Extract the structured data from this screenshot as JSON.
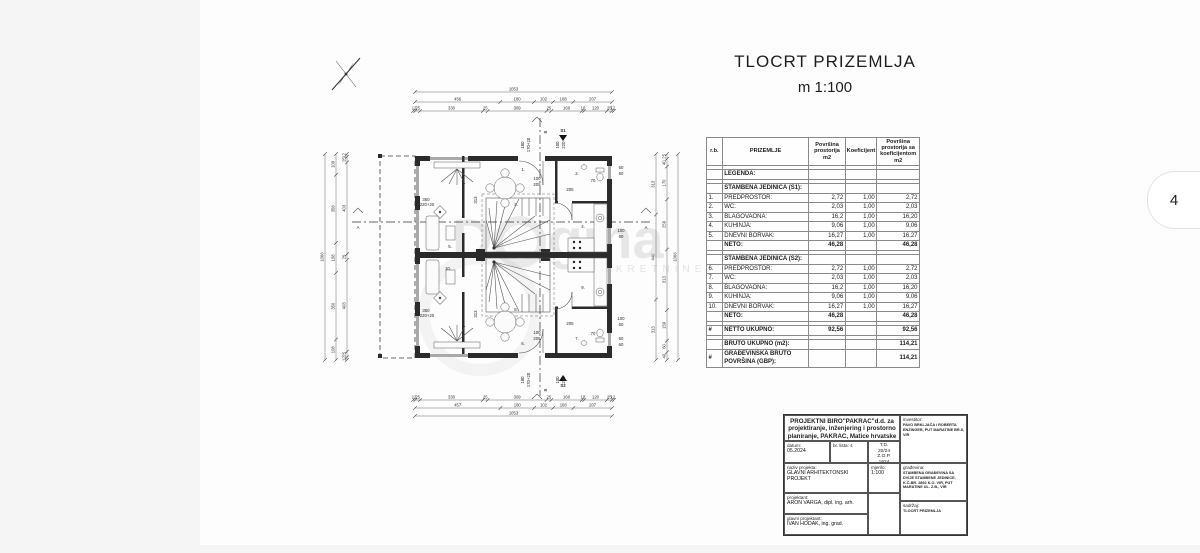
{
  "page": {
    "tab_number": "4"
  },
  "title": {
    "main": "TLOCRT  PRIZEMLJA",
    "scale": "m 1:100"
  },
  "watermark": {
    "part1": "D",
    "part2": "gma",
    "sub": "NEKRETNINE"
  },
  "plan": {
    "markers": {
      "a": "A",
      "b": "B",
      "s1": "S1",
      "s2": "S2"
    },
    "dims": {
      "top_total": [
        "1053"
      ],
      "top_mid": [
        "456",
        "180",
        "102",
        "108",
        "207"
      ],
      "top_small": [
        "12",
        "25",
        "330",
        "25",
        "309",
        "25",
        "160",
        "10",
        "120",
        "25",
        "12"
      ],
      "bot_small": [
        "12",
        "25",
        "330",
        "25",
        "309",
        "25",
        "160",
        "10",
        "120",
        "25",
        "12"
      ],
      "bot_mid": [
        "457",
        "180",
        "102",
        "108",
        "207"
      ],
      "bot_total": [
        "1053"
      ],
      "left_small": [
        "12",
        "25",
        "403",
        "25",
        "403",
        "25",
        "12"
      ],
      "left_mid": [
        "109",
        "358",
        "158",
        "350",
        "108"
      ],
      "left_total": [
        "1066"
      ],
      "right_inner": [
        "313",
        "440",
        "313"
      ],
      "right_mid": [
        "25",
        "40",
        "170",
        "259",
        "313",
        "159",
        "60",
        "40"
      ],
      "right_total": [
        "1066"
      ]
    },
    "labels": [
      {
        "t": "180",
        "x": 224,
        "y": 97,
        "r": -90
      },
      {
        "t": "170+20",
        "x": 230,
        "y": 97,
        "r": -90
      },
      {
        "t": "100",
        "x": 259,
        "y": 97,
        "r": -90
      },
      {
        "t": "220",
        "x": 265,
        "y": 97,
        "r": -90
      },
      {
        "t": "180",
        "x": 224,
        "y": 332,
        "r": -90
      },
      {
        "t": "170+20",
        "x": 230,
        "y": 332,
        "r": -90
      },
      {
        "t": "100",
        "x": 259,
        "y": 332,
        "r": -90
      },
      {
        "t": "220",
        "x": 265,
        "y": 332,
        "r": -90
      },
      {
        "t": "100",
        "x": 237,
        "y": 132
      },
      {
        "t": "205",
        "x": 237,
        "y": 138
      },
      {
        "t": "205",
        "x": 270,
        "y": 143
      },
      {
        "t": "100",
        "x": 237,
        "y": 286
      },
      {
        "t": "205",
        "x": 237,
        "y": 292
      },
      {
        "t": "205",
        "x": 270,
        "y": 277
      },
      {
        "t": "70",
        "x": 293,
        "y": 134
      },
      {
        "t": "70",
        "x": 293,
        "y": 287
      },
      {
        "t": "60",
        "x": 321,
        "y": 121
      },
      {
        "t": "60",
        "x": 321,
        "y": 127
      },
      {
        "t": "100",
        "x": 321,
        "y": 184
      },
      {
        "t": "60",
        "x": 321,
        "y": 190
      },
      {
        "t": "100",
        "x": 321,
        "y": 272
      },
      {
        "t": "60",
        "x": 321,
        "y": 278
      },
      {
        "t": "60",
        "x": 321,
        "y": 292
      },
      {
        "t": "60",
        "x": 321,
        "y": 298
      },
      {
        "t": "350",
        "x": 126,
        "y": 153
      },
      {
        "t": "220+20",
        "x": 127,
        "y": 158
      },
      {
        "t": "350",
        "x": 126,
        "y": 264
      },
      {
        "t": "220+20",
        "x": 127,
        "y": 269
      },
      {
        "t": "313",
        "x": 177,
        "y": 152,
        "r": -90
      },
      {
        "t": "313",
        "x": 177,
        "y": 266,
        "r": -90
      },
      {
        "t": "1.",
        "x": 223,
        "y": 123
      },
      {
        "t": "2.",
        "x": 277,
        "y": 127
      },
      {
        "t": "3.",
        "x": 216,
        "y": 158
      },
      {
        "t": "4.",
        "x": 283,
        "y": 180
      },
      {
        "t": "5.",
        "x": 150,
        "y": 200
      },
      {
        "t": "6.",
        "x": 223,
        "y": 297
      },
      {
        "t": "7.",
        "x": 277,
        "y": 292
      },
      {
        "t": "8.",
        "x": 216,
        "y": 263
      },
      {
        "t": "9.",
        "x": 283,
        "y": 241
      },
      {
        "t": "10.",
        "x": 148,
        "y": 222
      }
    ]
  },
  "area_table": {
    "headers": [
      "r.b.",
      "PRIZEMLJE",
      "Površina prostorija m2",
      "Koeficijent",
      "Površina prostorija sa koeficijentom m2"
    ],
    "rows": [
      [
        "",
        "",
        "",
        "",
        "",
        "s"
      ],
      [
        "",
        "LEGENDA:",
        "",
        "",
        "",
        "g"
      ],
      [
        "",
        "",
        "",
        "",
        "",
        "s"
      ],
      [
        "",
        "STAMBENA  JEDINICA (S1):",
        "",
        "",
        "",
        "g"
      ],
      [
        "1.",
        "PREDPROSTOR:",
        "2,72",
        "1,00",
        "2,72",
        "n"
      ],
      [
        "2.",
        "WC:",
        "2,03",
        "1,00",
        "2,03",
        "n"
      ],
      [
        "3.",
        "BLAGOVAONA:",
        "16,2",
        "1,00",
        "16,20",
        "n"
      ],
      [
        "4.",
        "KUHINJA:",
        "9,06",
        "1,00",
        "9,06",
        "n"
      ],
      [
        "5.",
        "DNEVNI BORVAK:",
        "16,27",
        "1,00",
        "16,27",
        "n"
      ],
      [
        "",
        "NETO:",
        "46,28",
        "",
        "46,28",
        "t"
      ],
      [
        "",
        "",
        "",
        "",
        "",
        "s"
      ],
      [
        "",
        "STAMBENA  JEDINICA (S2):",
        "",
        "",
        "",
        "g"
      ],
      [
        "6.",
        "PREDPROSTOR:",
        "2,72",
        "1,00",
        "2,72",
        "n"
      ],
      [
        "7.",
        "WC:",
        "2,03",
        "1,00",
        "2,03",
        "n"
      ],
      [
        "8.",
        "BLAGOVAONA:",
        "16,2",
        "1,00",
        "16,20",
        "n"
      ],
      [
        "9.",
        "KUHINJA:",
        "9,06",
        "1,00",
        "9,06",
        "n"
      ],
      [
        "10.",
        "DNEVNI BORVAK:",
        "16,27",
        "1,00",
        "16,27",
        "n"
      ],
      [
        "",
        "NETO:",
        "46,28",
        "",
        "46,28",
        "t"
      ],
      [
        "",
        "",
        "",
        "",
        "",
        "s"
      ],
      [
        "#",
        "NETTO UKUPNO:",
        "92,56",
        "",
        "92,56",
        "t"
      ],
      [
        "",
        "",
        "",
        "",
        "",
        "s"
      ],
      [
        "",
        "BRUTO UKUPNO (m2):",
        "",
        "",
        "114,21",
        "t"
      ],
      [
        "#",
        "GRAĐEVINSKA BRUTO POVRŠINA (GBP):",
        "",
        "",
        "114,21",
        "t"
      ]
    ]
  },
  "title_block": {
    "company": "PROJEKTNI BIRO\"PAKRAC\"d.d. za projektiranje, inženjering i prostorno planiranje, PAKRAC, Matice hrvatske 2",
    "datum_label": "datum:",
    "datum": "05.2024",
    "br_lista": "br. lista: 4",
    "td1": "T.D.",
    "td2": "20/24",
    "td3": "Z.O.P.",
    "td4": "1624",
    "investitor_label": "investitor:",
    "investitor": "PAVO BRKLJAČA i ROBERTA ENZINGER, PUT MARATINE BR.8, VIR",
    "naziv_label": "naziv projekta:",
    "naziv": "GLAVNI ARHITEKTONSKI PROJEKT",
    "mjerilo_label": "mjerilo:",
    "mjerilo": "1:100",
    "gradevina_label": "građevina:",
    "gradevina": "STAMBENA GRAĐEVINA SA DVIJE STAMBENE JEDINICE, K.Č.BR. 2892 K.O. VIR, PUT MARATINE UL. Z.B., VIR",
    "projektant_label": "projektant:",
    "projektant": "ARON VARGA, dipl. ing. arh.",
    "glavni_label": "glavni projektant:",
    "glavni": "IVAN HODAK, ing. grad.",
    "sadrzaj_label": "sadržaj:",
    "sadrzaj": "TLOCRT PRIZEMLJA"
  }
}
